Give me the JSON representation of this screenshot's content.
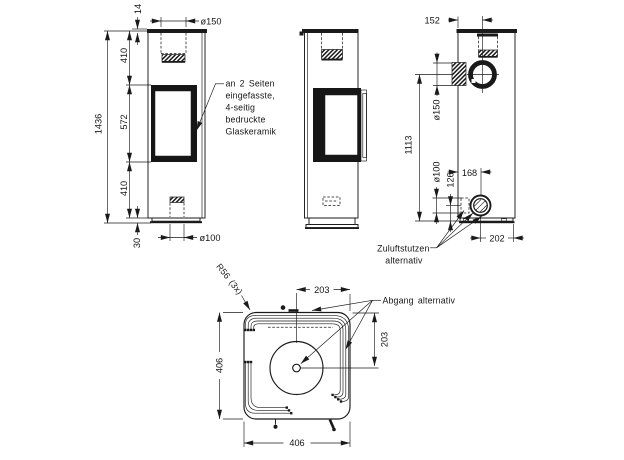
{
  "drawing": {
    "front": {
      "dim_plate": "14",
      "dim_flue": "ø150",
      "dim_top_window": "410",
      "dim_total_height": "1436",
      "dim_window": "572",
      "dim_window_base": "410",
      "dim_plinth": "30",
      "dim_intake": "ø100",
      "note_l1": "an 2 Seiten",
      "note_l2": "eingefasste,",
      "note_l3": "4-seitig",
      "note_l4": "bedruckte",
      "note_l5": "Glaskeramik"
    },
    "rear": {
      "dim_flue_offset": "152",
      "dim_side_flue": "ø150",
      "dim_flue_height": "1113",
      "dim_intake_height": "126",
      "dim_intake_dia": "ø100",
      "dim_intake_offset": "168",
      "dim_base_offset": "202",
      "label_l1": "Zuluftstutzen",
      "label_l2": "alternativ"
    },
    "top": {
      "dim_center_right": "203",
      "dim_top_center": "203",
      "dim_depth": "406",
      "dim_width": "406",
      "radius_note": "R56 (3x)",
      "outlet_label": "Abgang alternativ"
    }
  }
}
